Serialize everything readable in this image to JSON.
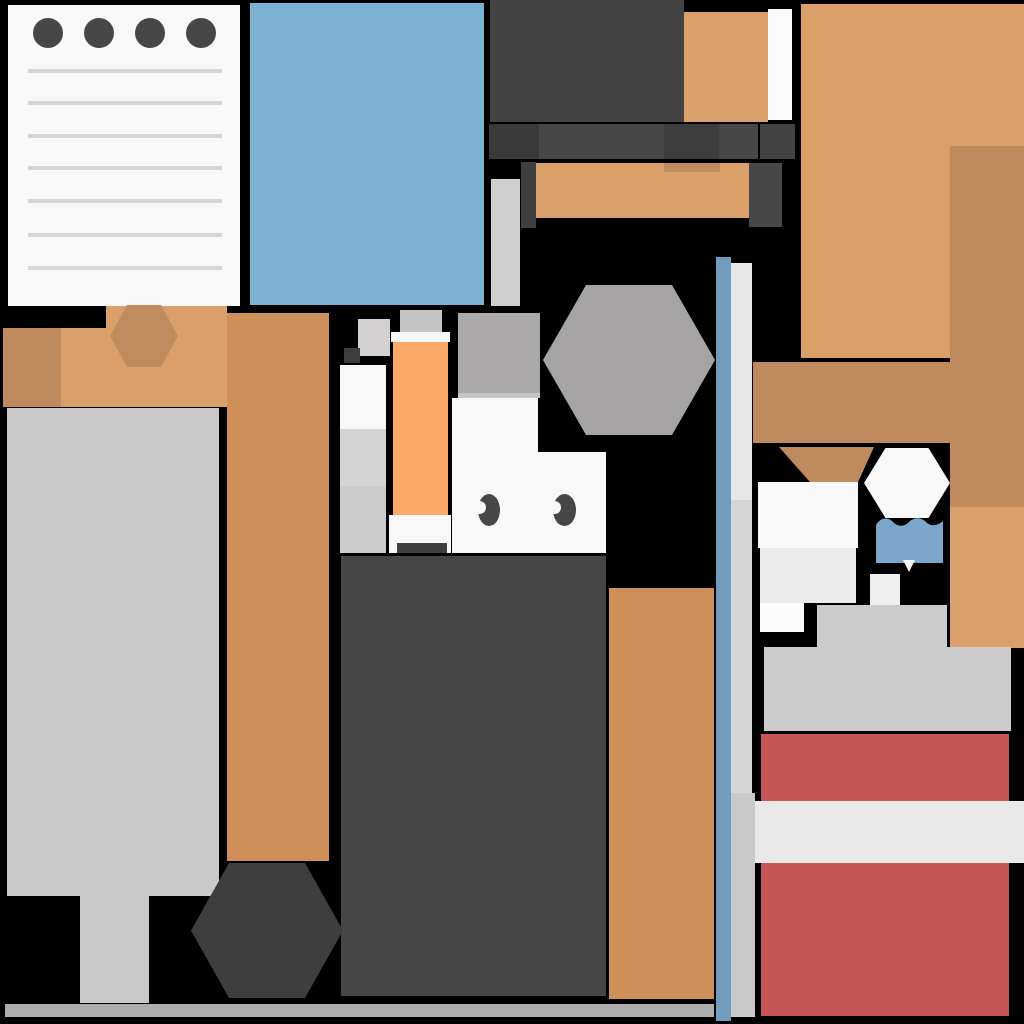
{
  "scene": {
    "background": "#000000",
    "width": 1024,
    "height": 1024,
    "description": "Top-down flat game room scene made of colored blocks, no visible text",
    "palette": {
      "paper": "#F8F8F8",
      "dark_gray": "#434343",
      "light_orange": "#DBA06A",
      "tan": "#BE8A5E",
      "mid_orange": "#CE9058",
      "bright_orange": "#FBA968",
      "mat_blue": "#7CB1D4",
      "wall_blue": "#729CBE",
      "red": "#C65657",
      "table_gray": "#C9C9C9"
    },
    "shapes": [
      {
        "name": "notepad-paper",
        "kind": "rect",
        "x": 8,
        "y": 5,
        "w": 232,
        "h": 301,
        "color": "#F8F8F8",
        "interactable": true
      },
      {
        "name": "notepad-hole-1",
        "kind": "circle",
        "x": 33,
        "y": 18,
        "w": 30,
        "h": 30,
        "color": "#474747",
        "interactable": false
      },
      {
        "name": "notepad-hole-2",
        "kind": "circle",
        "x": 84,
        "y": 18,
        "w": 30,
        "h": 30,
        "color": "#474747",
        "interactable": false
      },
      {
        "name": "notepad-hole-3",
        "kind": "circle",
        "x": 135,
        "y": 18,
        "w": 30,
        "h": 30,
        "color": "#474747",
        "interactable": false
      },
      {
        "name": "notepad-hole-4",
        "kind": "circle",
        "x": 186,
        "y": 18,
        "w": 30,
        "h": 30,
        "color": "#474747",
        "interactable": false
      },
      {
        "name": "notepad-line-1",
        "kind": "rect",
        "x": 28,
        "y": 69,
        "w": 194,
        "h": 4,
        "color": "#D6D6D6",
        "interactable": false
      },
      {
        "name": "notepad-line-2",
        "kind": "rect",
        "x": 28,
        "y": 101,
        "w": 194,
        "h": 4,
        "color": "#D6D6D6",
        "interactable": false
      },
      {
        "name": "notepad-line-3",
        "kind": "rect",
        "x": 28,
        "y": 134,
        "w": 194,
        "h": 4,
        "color": "#D6D6D6",
        "interactable": false
      },
      {
        "name": "notepad-line-4",
        "kind": "rect",
        "x": 28,
        "y": 166,
        "w": 194,
        "h": 4,
        "color": "#D6D6D6",
        "interactable": false
      },
      {
        "name": "notepad-line-5",
        "kind": "rect",
        "x": 28,
        "y": 199,
        "w": 194,
        "h": 4,
        "color": "#D6D6D6",
        "interactable": false
      },
      {
        "name": "notepad-line-6",
        "kind": "rect",
        "x": 28,
        "y": 233,
        "w": 194,
        "h": 4,
        "color": "#D6D6D6",
        "interactable": false
      },
      {
        "name": "notepad-line-7",
        "kind": "rect",
        "x": 28,
        "y": 266,
        "w": 194,
        "h": 4,
        "color": "#D6D6D6",
        "interactable": false
      },
      {
        "name": "blue-mat",
        "kind": "rect",
        "x": 250,
        "y": 3,
        "w": 234,
        "h": 302,
        "color": "#7CB1D4",
        "interactable": true
      },
      {
        "name": "dark-cabinet-top",
        "kind": "rect",
        "x": 490,
        "y": 0,
        "w": 194,
        "h": 122,
        "color": "#434343",
        "interactable": true
      },
      {
        "name": "orange-crate-top",
        "kind": "rect",
        "x": 684,
        "y": 12,
        "w": 84,
        "h": 110,
        "color": "#DBA06A",
        "interactable": true
      },
      {
        "name": "white-panel-top",
        "kind": "rect",
        "x": 768,
        "y": 9,
        "w": 24,
        "h": 111,
        "color": "#FAFAFA",
        "interactable": false
      },
      {
        "name": "orange-rug-topright",
        "kind": "rect",
        "x": 801,
        "y": 4,
        "w": 223,
        "h": 354,
        "color": "#DBA06A",
        "interactable": true
      },
      {
        "name": "tan-column-right",
        "kind": "rect",
        "x": 950,
        "y": 146,
        "w": 74,
        "h": 361,
        "color": "#BE8A5E",
        "interactable": true
      },
      {
        "name": "orange-column-right-lower",
        "kind": "rect",
        "x": 950,
        "y": 507,
        "w": 74,
        "h": 141,
        "color": "#DBA06A",
        "interactable": false
      },
      {
        "name": "dark-shelf-seg-1",
        "kind": "rect",
        "x": 489,
        "y": 124,
        "w": 50,
        "h": 35,
        "color": "#3A3A3A",
        "interactable": false
      },
      {
        "name": "dark-shelf-seg-2",
        "kind": "rect",
        "x": 539,
        "y": 124,
        "w": 125,
        "h": 35,
        "color": "#474747",
        "interactable": false
      },
      {
        "name": "dark-shelf-seg-3",
        "kind": "rect",
        "x": 664,
        "y": 124,
        "w": 55,
        "h": 35,
        "color": "#3D3D3D",
        "interactable": false
      },
      {
        "name": "dark-shelf-seg-4",
        "kind": "rect",
        "x": 719,
        "y": 124,
        "w": 39,
        "h": 35,
        "color": "#474747",
        "interactable": false
      },
      {
        "name": "dark-shelf-seg-5",
        "kind": "rect",
        "x": 760,
        "y": 124,
        "w": 35,
        "h": 35,
        "color": "#434343",
        "interactable": false
      },
      {
        "name": "light-strip-mid",
        "kind": "rect",
        "x": 491,
        "y": 179,
        "w": 29,
        "h": 127,
        "color": "#CFCFCF",
        "interactable": false
      },
      {
        "name": "orange-bench-mid",
        "kind": "rect",
        "x": 535,
        "y": 163,
        "w": 214,
        "h": 55,
        "color": "#DBA06A",
        "interactable": true
      },
      {
        "name": "tan-bench-shade",
        "kind": "rect",
        "x": 664,
        "y": 163,
        "w": 56,
        "h": 9,
        "color": "#C08B5F",
        "interactable": false
      },
      {
        "name": "dark-bench-leg-left",
        "kind": "rect",
        "x": 521,
        "y": 162,
        "w": 15,
        "h": 66,
        "color": "#3F3F3F",
        "interactable": false
      },
      {
        "name": "dark-bench-leg-right",
        "kind": "rect",
        "x": 749,
        "y": 163,
        "w": 33,
        "h": 64,
        "color": "#474747",
        "interactable": false
      },
      {
        "name": "orange-band-left",
        "kind": "rect",
        "x": 3,
        "y": 328,
        "w": 239,
        "h": 79,
        "color": "#DBA06A",
        "interactable": true
      },
      {
        "name": "orange-band-left-raised",
        "kind": "rect",
        "x": 106,
        "y": 306,
        "w": 121,
        "h": 22,
        "color": "#DBA06A",
        "interactable": false
      },
      {
        "name": "tan-square-left",
        "kind": "rect",
        "x": 3,
        "y": 328,
        "w": 58,
        "h": 79,
        "color": "#BE8A5E",
        "interactable": false
      },
      {
        "name": "tan-hexagon-left",
        "kind": "hex",
        "x": 110,
        "y": 305,
        "w": 68,
        "h": 62,
        "color": "#C08B5F",
        "interactable": true
      },
      {
        "name": "orange-column-left",
        "kind": "rect",
        "x": 227,
        "y": 313,
        "w": 102,
        "h": 548,
        "color": "#CE9058",
        "interactable": true
      },
      {
        "name": "gray-table",
        "kind": "rect",
        "x": 7,
        "y": 408,
        "w": 212,
        "h": 488,
        "color": "#C9C9C9",
        "interactable": true
      },
      {
        "name": "gray-table-leg",
        "kind": "rect",
        "x": 80,
        "y": 896,
        "w": 69,
        "h": 107,
        "color": "#C9C9C9",
        "interactable": false
      },
      {
        "name": "small-gray-block-a",
        "kind": "rect",
        "x": 400,
        "y": 310,
        "w": 42,
        "h": 22,
        "color": "#C6C4C4",
        "interactable": false
      },
      {
        "name": "small-gray-block-b",
        "kind": "rect",
        "x": 358,
        "y": 319,
        "w": 32,
        "h": 37,
        "color": "#D2D0D0",
        "interactable": false
      },
      {
        "name": "small-dark-square",
        "kind": "rect",
        "x": 344,
        "y": 348,
        "w": 16,
        "h": 15,
        "color": "#3E3E3E",
        "interactable": false
      },
      {
        "name": "white-column-top",
        "kind": "rect",
        "x": 340,
        "y": 365,
        "w": 46,
        "h": 64,
        "color": "#F8F8F8",
        "interactable": false
      },
      {
        "name": "white-column-mid",
        "kind": "rect",
        "x": 340,
        "y": 429,
        "w": 46,
        "h": 57,
        "color": "#D4D4D4",
        "interactable": false
      },
      {
        "name": "white-column-bottom",
        "kind": "rect",
        "x": 340,
        "y": 486,
        "w": 46,
        "h": 67,
        "color": "#CBCBCB",
        "interactable": false
      },
      {
        "name": "orange-column-mid-cap",
        "kind": "rect",
        "x": 391,
        "y": 332,
        "w": 59,
        "h": 10,
        "color": "#F6F6F6",
        "interactable": false
      },
      {
        "name": "orange-column-mid",
        "kind": "rect",
        "x": 393,
        "y": 342,
        "w": 55,
        "h": 175,
        "color": "#FBA968",
        "interactable": true
      },
      {
        "name": "orange-column-mid-base",
        "kind": "rect",
        "x": 389,
        "y": 515,
        "w": 62,
        "h": 38,
        "color": "#F8F8F8",
        "interactable": false
      },
      {
        "name": "orange-column-mid-base-bar",
        "kind": "rect",
        "x": 397,
        "y": 543,
        "w": 50,
        "h": 10,
        "color": "#3F3F3F",
        "interactable": false
      },
      {
        "name": "character-hair",
        "kind": "rect",
        "x": 458,
        "y": 313,
        "w": 82,
        "h": 85,
        "color": "#ABA9A9",
        "interactable": false
      },
      {
        "name": "character-hair-edge",
        "kind": "rect",
        "x": 458,
        "y": 393,
        "w": 82,
        "h": 5,
        "color": "#C4C4C4",
        "interactable": false
      },
      {
        "name": "character-body-upper",
        "kind": "rect",
        "x": 452,
        "y": 398,
        "w": 86,
        "h": 54,
        "color": "#F8F8F8",
        "interactable": true
      },
      {
        "name": "character-body-lower",
        "kind": "rect",
        "x": 452,
        "y": 452,
        "w": 154,
        "h": 101,
        "color": "#F8F8F8",
        "interactable": true
      },
      {
        "name": "character-eye-left",
        "kind": "eye",
        "x": 478,
        "y": 494,
        "w": 22,
        "h": 32,
        "color": "#474747",
        "interactable": false
      },
      {
        "name": "character-eye-right",
        "kind": "eye",
        "x": 553,
        "y": 494,
        "w": 23,
        "h": 32,
        "color": "#474747",
        "interactable": false
      },
      {
        "name": "gray-hexagon-table",
        "kind": "hex",
        "x": 543,
        "y": 285,
        "w": 172,
        "h": 150,
        "color": "#A5A3A3",
        "interactable": true
      },
      {
        "name": "dark-rug-bottom",
        "kind": "rect",
        "x": 341,
        "y": 556,
        "w": 265,
        "h": 440,
        "color": "#464646",
        "interactable": true
      },
      {
        "name": "orange-column-center",
        "kind": "rect",
        "x": 609,
        "y": 588,
        "w": 105,
        "h": 411,
        "color": "#CE9058",
        "interactable": true
      },
      {
        "name": "dark-hexagon-table",
        "kind": "hex",
        "x": 191,
        "y": 863,
        "w": 152,
        "h": 135,
        "color": "#3E3E3E",
        "interactable": true
      },
      {
        "name": "bottom-baseboard",
        "kind": "rect",
        "x": 5,
        "y": 1004,
        "w": 709,
        "h": 13,
        "color": "#ADADAD",
        "interactable": false
      },
      {
        "name": "blue-wall-divider",
        "kind": "rect",
        "x": 716,
        "y": 257,
        "w": 15,
        "h": 764,
        "color": "#729CBE",
        "interactable": false
      },
      {
        "name": "wall-strip-upper",
        "kind": "rect",
        "x": 731,
        "y": 263,
        "w": 21,
        "h": 237,
        "color": "#E7E7E7",
        "interactable": false
      },
      {
        "name": "wall-strip-mid",
        "kind": "rect",
        "x": 731,
        "y": 500,
        "w": 21,
        "h": 293,
        "color": "#D6D6D6",
        "interactable": false
      },
      {
        "name": "wall-strip-lower",
        "kind": "rect",
        "x": 731,
        "y": 793,
        "w": 24,
        "h": 224,
        "color": "#C9C9C9",
        "interactable": false
      },
      {
        "name": "tan-bar-right",
        "kind": "rect",
        "x": 753,
        "y": 362,
        "w": 197,
        "h": 81,
        "color": "#BE8A5E",
        "interactable": true
      },
      {
        "name": "tan-triangle",
        "kind": "tri",
        "x": 779,
        "y": 447,
        "w": 95,
        "h": 71,
        "points": "0% 0%, 100% 0%, 66% 100%",
        "color": "#BE8A5E",
        "interactable": false
      },
      {
        "name": "white-hexagon-table",
        "kind": "hex",
        "x": 864,
        "y": 448,
        "w": 86,
        "h": 70,
        "color": "#F8F8F8",
        "interactable": true
      },
      {
        "name": "blue-cup",
        "kind": "path",
        "x": 876,
        "y": 513,
        "w": 67,
        "h": 50,
        "viewBox": "0 0 67 50",
        "d": "M0 12 C5 4 12 4 17 9 C22 14 28 14 33 9 C38 4 45 4 50 9 C55 14 61 13 67 8 L67 50 L0 50 Z",
        "color": "#7BA7CC",
        "interactable": true
      },
      {
        "name": "blue-cup-notch",
        "kind": "tri",
        "x": 903,
        "y": 560,
        "w": 12,
        "h": 12,
        "points": "0% 0%, 100% 0%, 50% 100%",
        "color": "#F8F8F8",
        "interactable": false
      },
      {
        "name": "white-mat-right",
        "kind": "rect",
        "x": 758,
        "y": 482,
        "w": 100,
        "h": 66,
        "color": "#F8F8F8",
        "interactable": true
      },
      {
        "name": "gray-mat-right",
        "kind": "rect",
        "x": 760,
        "y": 548,
        "w": 96,
        "h": 55,
        "color": "#EBEBEB",
        "interactable": false
      },
      {
        "name": "white-small-right",
        "kind": "rect",
        "x": 760,
        "y": 603,
        "w": 44,
        "h": 29,
        "color": "#FAFAFA",
        "interactable": false
      },
      {
        "name": "small-square-right",
        "kind": "rect",
        "x": 870,
        "y": 574,
        "w": 30,
        "h": 33,
        "color": "#EFEFEF",
        "interactable": false
      },
      {
        "name": "gray-block-step",
        "kind": "rect",
        "x": 817,
        "y": 605,
        "w": 130,
        "h": 42,
        "color": "#CBCBCB",
        "interactable": false
      },
      {
        "name": "gray-block-main",
        "kind": "rect",
        "x": 764,
        "y": 647,
        "w": 247,
        "h": 84,
        "color": "#CBCBCB",
        "interactable": true
      },
      {
        "name": "red-crate",
        "kind": "rect",
        "x": 761,
        "y": 734,
        "w": 248,
        "h": 282,
        "color": "#C65657",
        "interactable": true
      },
      {
        "name": "white-stripe",
        "kind": "rect",
        "x": 755,
        "y": 801,
        "w": 269,
        "h": 62,
        "color": "#E9E9E9",
        "interactable": false
      }
    ]
  }
}
